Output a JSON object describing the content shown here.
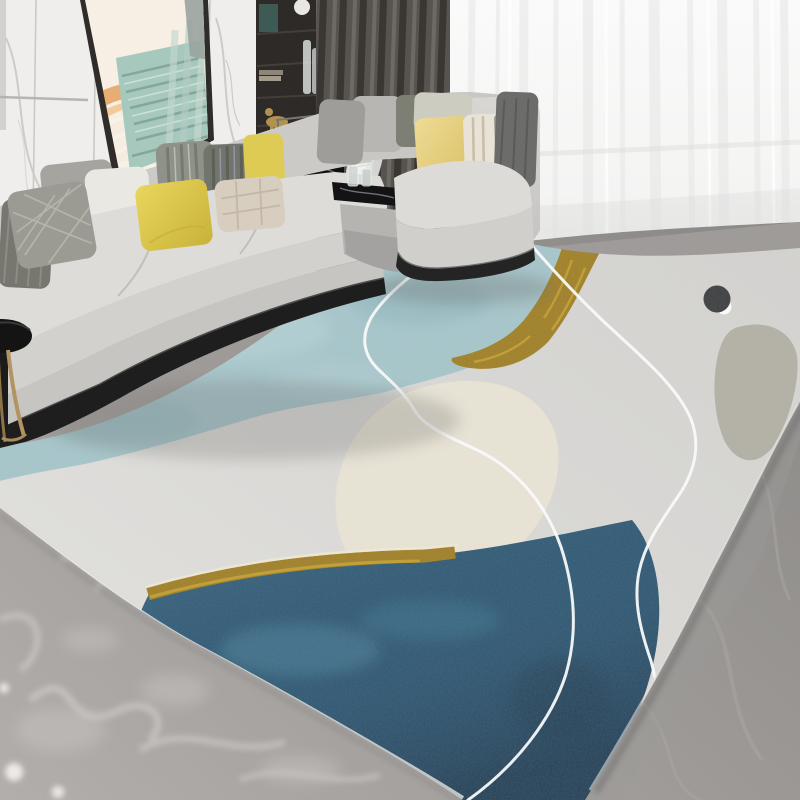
{
  "scene": {
    "type": "interior-photo",
    "subject": "modern living room with light gray L-shaped sectional sofa and abstract area rug",
    "objects": [
      {
        "name": "marble-wall",
        "desc": "white marble panel wall with gray veining, left side"
      },
      {
        "name": "artwork",
        "desc": "leaning framed print of peach arches and teal stairs"
      },
      {
        "name": "shelf-cabinet",
        "desc": "dark display cabinet with vases, books, gold figurine"
      },
      {
        "name": "dark-curtain",
        "desc": "charcoal pleated drape"
      },
      {
        "name": "sheer-curtain",
        "desc": "white sheer curtain over window, right side"
      },
      {
        "name": "sectional-sofa",
        "desc": "light gray fabric sofa with chaise and throw pillows"
      },
      {
        "name": "pillows",
        "desc": "gray, white, yellow, striped and quilted cushions"
      },
      {
        "name": "side-table",
        "desc": "small round black table with brass legs, lower left"
      },
      {
        "name": "console-table",
        "desc": "black marble module with white abstract sculpture and bowl"
      },
      {
        "name": "area-rug",
        "desc": "abstract rug: light gray base, soft blue field, gold bands, cream blob, navy mountain, gray blob, dark dot, white contour lines"
      },
      {
        "name": "marble-floor",
        "desc": "gray marble tile floor"
      }
    ]
  },
  "palette": {
    "wall": {
      "marble_base": "#f0eeec",
      "vein": "#c2bfbc"
    },
    "curtains": {
      "sheer": "#f7f7f6",
      "dark": "#57534e"
    },
    "artwork": {
      "orange": "#eab77e",
      "teal": "#a6c8bd",
      "white": "#f8f3ec",
      "frame": "#2f2c29"
    },
    "cabinet": {
      "body": "#2e2a27"
    },
    "sofa": {
      "fabric": "#dddcd9",
      "fabric_mid": "#d2d1ce",
      "fabric_deep": "#c6c5c2",
      "back": "#cbcac7",
      "base_dark": "#1e1e1e"
    },
    "pillows": {
      "knit_gray": "#77766f",
      "crosshatch_silver": "#9c9b93",
      "marble_gray": "#a5a49f",
      "white": "#eae8e3",
      "yellow_left": "#ddc845",
      "green_stripe": "#8e9288",
      "dark_stripe": "#71756b",
      "yellow_right": "#ddcb54",
      "beige_quilt": "#d8cec0",
      "corner_gray": "#9e9d9a",
      "corner_light": "#b7b6b2",
      "dark_sage": "#7d7f74",
      "silver_sage": "#ccccc0",
      "chaise_yellow": "#e7d282",
      "cream_stripe": "#e8e3d6",
      "charcoal": "#6c6c6a"
    },
    "side_table": {
      "top_black": "#141414",
      "brass": "#b29361"
    },
    "sculpture": {
      "white": "#f1f1ef"
    },
    "floor": {
      "left": "#aba7a4",
      "right": "#908e8c",
      "vein": "#d7d4d1"
    },
    "rug": {
      "base": "#dbdad7",
      "blue": "#a7c6cb",
      "gold": "#a1821f",
      "gold_light": "#c8a52f",
      "beige": "#e8e3d5",
      "navy": "#2c5a76",
      "navy_light": "#4e86a0",
      "gray_blob": "#b4b1a6",
      "dark_dot": "#3b3d3f",
      "white": "#fafbfb"
    }
  }
}
